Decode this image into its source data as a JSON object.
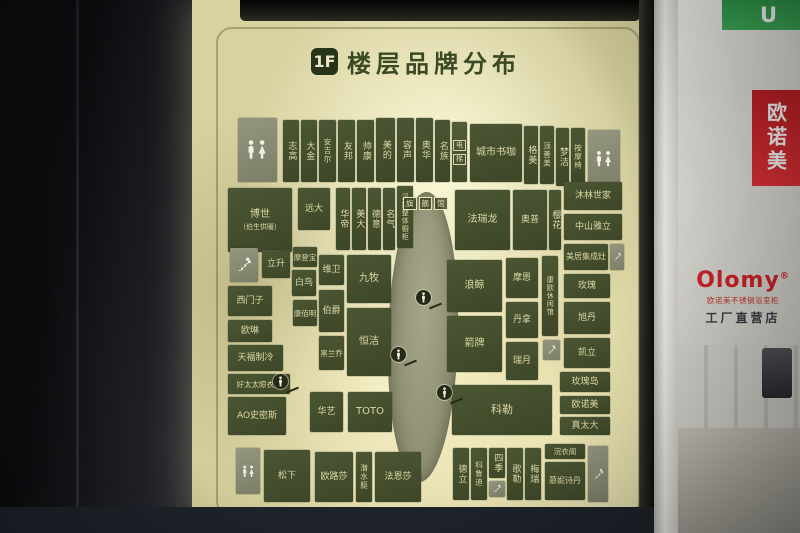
{
  "colors": {
    "block_green": "#45502f",
    "lightbox_cream": "#d9d3a2",
    "store_sign_green": "#35a04e",
    "banner_red": "#c4242b",
    "logo_red": "#d3232a",
    "title_green": "#3b4a24"
  },
  "sign": {
    "floor_badge": "1F",
    "title": "楼层品牌分布"
  },
  "map": {
    "atrium_boxes": [
      "旗",
      "舰",
      "馆"
    ],
    "markers": [
      {
        "x": 231,
        "y": 297
      },
      {
        "x": 206,
        "y": 354
      },
      {
        "x": 88,
        "y": 381
      },
      {
        "x": 252,
        "y": 392
      }
    ],
    "blocks": [
      {
        "label": "",
        "icon": "restroom",
        "type": "facility",
        "x": 46,
        "y": 118,
        "w": 39,
        "h": 64
      },
      {
        "label": "志高",
        "v": true,
        "x": 91,
        "y": 120,
        "w": 16,
        "h": 62
      },
      {
        "label": "大金",
        "v": true,
        "x": 109,
        "y": 120,
        "w": 16,
        "h": 62
      },
      {
        "label": "安吉尔",
        "v": true,
        "x": 127,
        "y": 120,
        "w": 17,
        "h": 62,
        "fs": 7.5
      },
      {
        "label": "友邦",
        "v": true,
        "x": 146,
        "y": 120,
        "w": 17,
        "h": 62
      },
      {
        "label": "帅康",
        "v": true,
        "x": 165,
        "y": 120,
        "w": 17,
        "h": 62
      },
      {
        "label": "美的",
        "v": true,
        "x": 184,
        "y": 118,
        "w": 19,
        "h": 64
      },
      {
        "label": "容声",
        "v": true,
        "x": 205,
        "y": 118,
        "w": 17,
        "h": 64
      },
      {
        "label": "奥华",
        "v": true,
        "x": 224,
        "y": 118,
        "w": 17,
        "h": 64
      },
      {
        "label": "名族",
        "v": true,
        "x": 243,
        "y": 120,
        "w": 15,
        "h": 62
      },
      {
        "label": "电梯",
        "boxed": true,
        "type": "facility-strip",
        "x": 260,
        "y": 122,
        "w": 15,
        "h": 60
      },
      {
        "label": "城市书咖",
        "x": 278,
        "y": 124,
        "w": 52,
        "h": 58,
        "fs": 10
      },
      {
        "label": "格美",
        "v": true,
        "x": 332,
        "y": 126,
        "w": 14,
        "h": 58
      },
      {
        "label": "顶善美",
        "v": true,
        "x": 348,
        "y": 126,
        "w": 14,
        "h": 58,
        "fs": 7.5
      },
      {
        "label": "梦洁",
        "v": true,
        "x": 364,
        "y": 128,
        "w": 13,
        "h": 58
      },
      {
        "label": "按摩椅",
        "v": true,
        "x": 379,
        "y": 128,
        "w": 14,
        "h": 58,
        "fs": 7.5
      },
      {
        "label": "",
        "icon": "restroom",
        "type": "facility",
        "x": 396,
        "y": 130,
        "w": 32,
        "h": 58
      },
      {
        "label": "博世",
        "sub": "（伯生供暖）",
        "two": true,
        "x": 36,
        "y": 188,
        "w": 64,
        "h": 64,
        "fs": 10
      },
      {
        "label": "远大",
        "x": 106,
        "y": 188,
        "w": 32,
        "h": 42
      },
      {
        "label": "华帝",
        "v": true,
        "x": 144,
        "y": 188,
        "w": 14,
        "h": 62
      },
      {
        "label": "美大",
        "v": true,
        "x": 160,
        "y": 188,
        "w": 14,
        "h": 62
      },
      {
        "label": "德意",
        "v": true,
        "x": 176,
        "y": 188,
        "w": 13,
        "h": 62
      },
      {
        "label": "名气",
        "v": true,
        "x": 191,
        "y": 188,
        "w": 12,
        "h": 62
      },
      {
        "label": "汉斯整体橱柜",
        "v": true,
        "x": 205,
        "y": 186,
        "w": 16,
        "h": 62,
        "fs": 7
      },
      {
        "label": "法瑞龙",
        "x": 263,
        "y": 190,
        "w": 55,
        "h": 60,
        "fs": 10
      },
      {
        "label": "奥普",
        "x": 321,
        "y": 190,
        "w": 34,
        "h": 60
      },
      {
        "label": "樱花",
        "v": true,
        "x": 357,
        "y": 190,
        "w": 12,
        "h": 60
      },
      {
        "label": "沐林世家",
        "x": 372,
        "y": 182,
        "w": 58,
        "h": 28
      },
      {
        "label": "中山雅立",
        "x": 372,
        "y": 214,
        "w": 58,
        "h": 26
      },
      {
        "label": "美居集成灶",
        "x": 372,
        "y": 244,
        "w": 44,
        "h": 26,
        "fs": 8
      },
      {
        "label": "",
        "icon": "stairs",
        "type": "facility",
        "x": 418,
        "y": 244,
        "w": 14,
        "h": 26
      },
      {
        "label": "",
        "icon": "stairs",
        "type": "facility",
        "x": 38,
        "y": 248,
        "w": 28,
        "h": 34
      },
      {
        "label": "立升",
        "x": 70,
        "y": 250,
        "w": 28,
        "h": 28
      },
      {
        "label": "摩登宝",
        "x": 101,
        "y": 247,
        "w": 24,
        "h": 20,
        "fs": 7.5
      },
      {
        "label": "白鸟",
        "x": 100,
        "y": 270,
        "w": 24,
        "h": 26
      },
      {
        "label": "康佰明",
        "x": 101,
        "y": 300,
        "w": 24,
        "h": 26,
        "fs": 7.5
      },
      {
        "label": "维卫",
        "x": 127,
        "y": 255,
        "w": 25,
        "h": 30
      },
      {
        "label": "伯爵",
        "x": 127,
        "y": 290,
        "w": 25,
        "h": 42
      },
      {
        "label": "黑兰乔",
        "x": 127,
        "y": 336,
        "w": 25,
        "h": 34,
        "fs": 7.5
      },
      {
        "label": "九牧",
        "x": 155,
        "y": 255,
        "w": 44,
        "h": 48,
        "fs": 10
      },
      {
        "label": "恒洁",
        "x": 155,
        "y": 308,
        "w": 44,
        "h": 68,
        "fs": 10
      },
      {
        "label": "西门子",
        "x": 36,
        "y": 286,
        "w": 44,
        "h": 30
      },
      {
        "label": "欧琳",
        "x": 36,
        "y": 320,
        "w": 44,
        "h": 22
      },
      {
        "label": "天福制冷",
        "x": 36,
        "y": 345,
        "w": 55,
        "h": 26
      },
      {
        "label": "好太太晾衣架",
        "x": 36,
        "y": 374,
        "w": 62,
        "h": 20,
        "fs": 7.5
      },
      {
        "label": "AO史密斯",
        "x": 36,
        "y": 397,
        "w": 58,
        "h": 38
      },
      {
        "label": "华艺",
        "x": 118,
        "y": 392,
        "w": 33,
        "h": 40
      },
      {
        "label": "TOTO",
        "x": 156,
        "y": 392,
        "w": 44,
        "h": 40,
        "fs": 10
      },
      {
        "label": "浪鲸",
        "x": 255,
        "y": 260,
        "w": 55,
        "h": 52,
        "fs": 10
      },
      {
        "label": "箭牌",
        "x": 255,
        "y": 316,
        "w": 55,
        "h": 56,
        "fs": 10
      },
      {
        "label": "摩恩",
        "x": 314,
        "y": 258,
        "w": 32,
        "h": 40
      },
      {
        "label": "丹拿",
        "x": 314,
        "y": 302,
        "w": 32,
        "h": 36
      },
      {
        "label": "瑞月",
        "x": 314,
        "y": 342,
        "w": 32,
        "h": 38
      },
      {
        "label": "康欧休闲馆",
        "v": true,
        "x": 350,
        "y": 256,
        "w": 16,
        "h": 80,
        "fs": 7
      },
      {
        "label": "",
        "icon": "stairs",
        "type": "facility",
        "x": 351,
        "y": 340,
        "w": 17,
        "h": 20
      },
      {
        "label": "玫瑰",
        "x": 372,
        "y": 274,
        "w": 46,
        "h": 24
      },
      {
        "label": "旭丹",
        "x": 372,
        "y": 302,
        "w": 46,
        "h": 32
      },
      {
        "label": "凯立",
        "x": 372,
        "y": 338,
        "w": 46,
        "h": 30
      },
      {
        "label": "玫瑰岛",
        "x": 368,
        "y": 372,
        "w": 50,
        "h": 20
      },
      {
        "label": "欧诺美",
        "x": 368,
        "y": 396,
        "w": 50,
        "h": 18
      },
      {
        "label": "真太大",
        "x": 368,
        "y": 417,
        "w": 50,
        "h": 18
      },
      {
        "label": "科勒",
        "x": 260,
        "y": 385,
        "w": 100,
        "h": 50,
        "fs": 11
      },
      {
        "label": "",
        "icon": "restroom",
        "type": "facility",
        "x": 44,
        "y": 448,
        "w": 24,
        "h": 46
      },
      {
        "label": "松下",
        "x": 72,
        "y": 450,
        "w": 46,
        "h": 52
      },
      {
        "label": "欧路莎",
        "x": 123,
        "y": 452,
        "w": 38,
        "h": 50
      },
      {
        "label": "潜水艇",
        "v": true,
        "x": 164,
        "y": 452,
        "w": 16,
        "h": 50,
        "fs": 7.5
      },
      {
        "label": "法恩莎",
        "x": 183,
        "y": 452,
        "w": 46,
        "h": 50
      },
      {
        "label": "德立",
        "v": true,
        "x": 261,
        "y": 448,
        "w": 16,
        "h": 52
      },
      {
        "label": "科鲁迪",
        "v": true,
        "x": 279,
        "y": 448,
        "w": 16,
        "h": 52,
        "fs": 7.5
      },
      {
        "label": "四季",
        "v": true,
        "x": 297,
        "y": 448,
        "w": 16,
        "h": 30
      },
      {
        "label": "",
        "icon": "stairs",
        "type": "facility",
        "x": 297,
        "y": 481,
        "w": 16,
        "h": 16
      },
      {
        "label": "歌勒",
        "v": true,
        "x": 315,
        "y": 448,
        "w": 16,
        "h": 52
      },
      {
        "label": "梅瑞",
        "v": true,
        "x": 333,
        "y": 448,
        "w": 16,
        "h": 52
      },
      {
        "label": "浣衣阁",
        "x": 353,
        "y": 444,
        "w": 40,
        "h": 15,
        "fs": 7.5
      },
      {
        "label": "慕妮诗丹",
        "x": 353,
        "y": 462,
        "w": 40,
        "h": 38,
        "fs": 8
      },
      {
        "label": "",
        "icon": "stairs",
        "type": "facility",
        "x": 396,
        "y": 446,
        "w": 20,
        "h": 56
      }
    ]
  },
  "storefront": {
    "sign_letter": "U",
    "banner_vertical": "欧诺美",
    "logo": "Olomy",
    "logo_mark": "®",
    "logo_sub": "欧诺美不锈钢浴室柜",
    "logo_tagline": "工厂直营店"
  }
}
